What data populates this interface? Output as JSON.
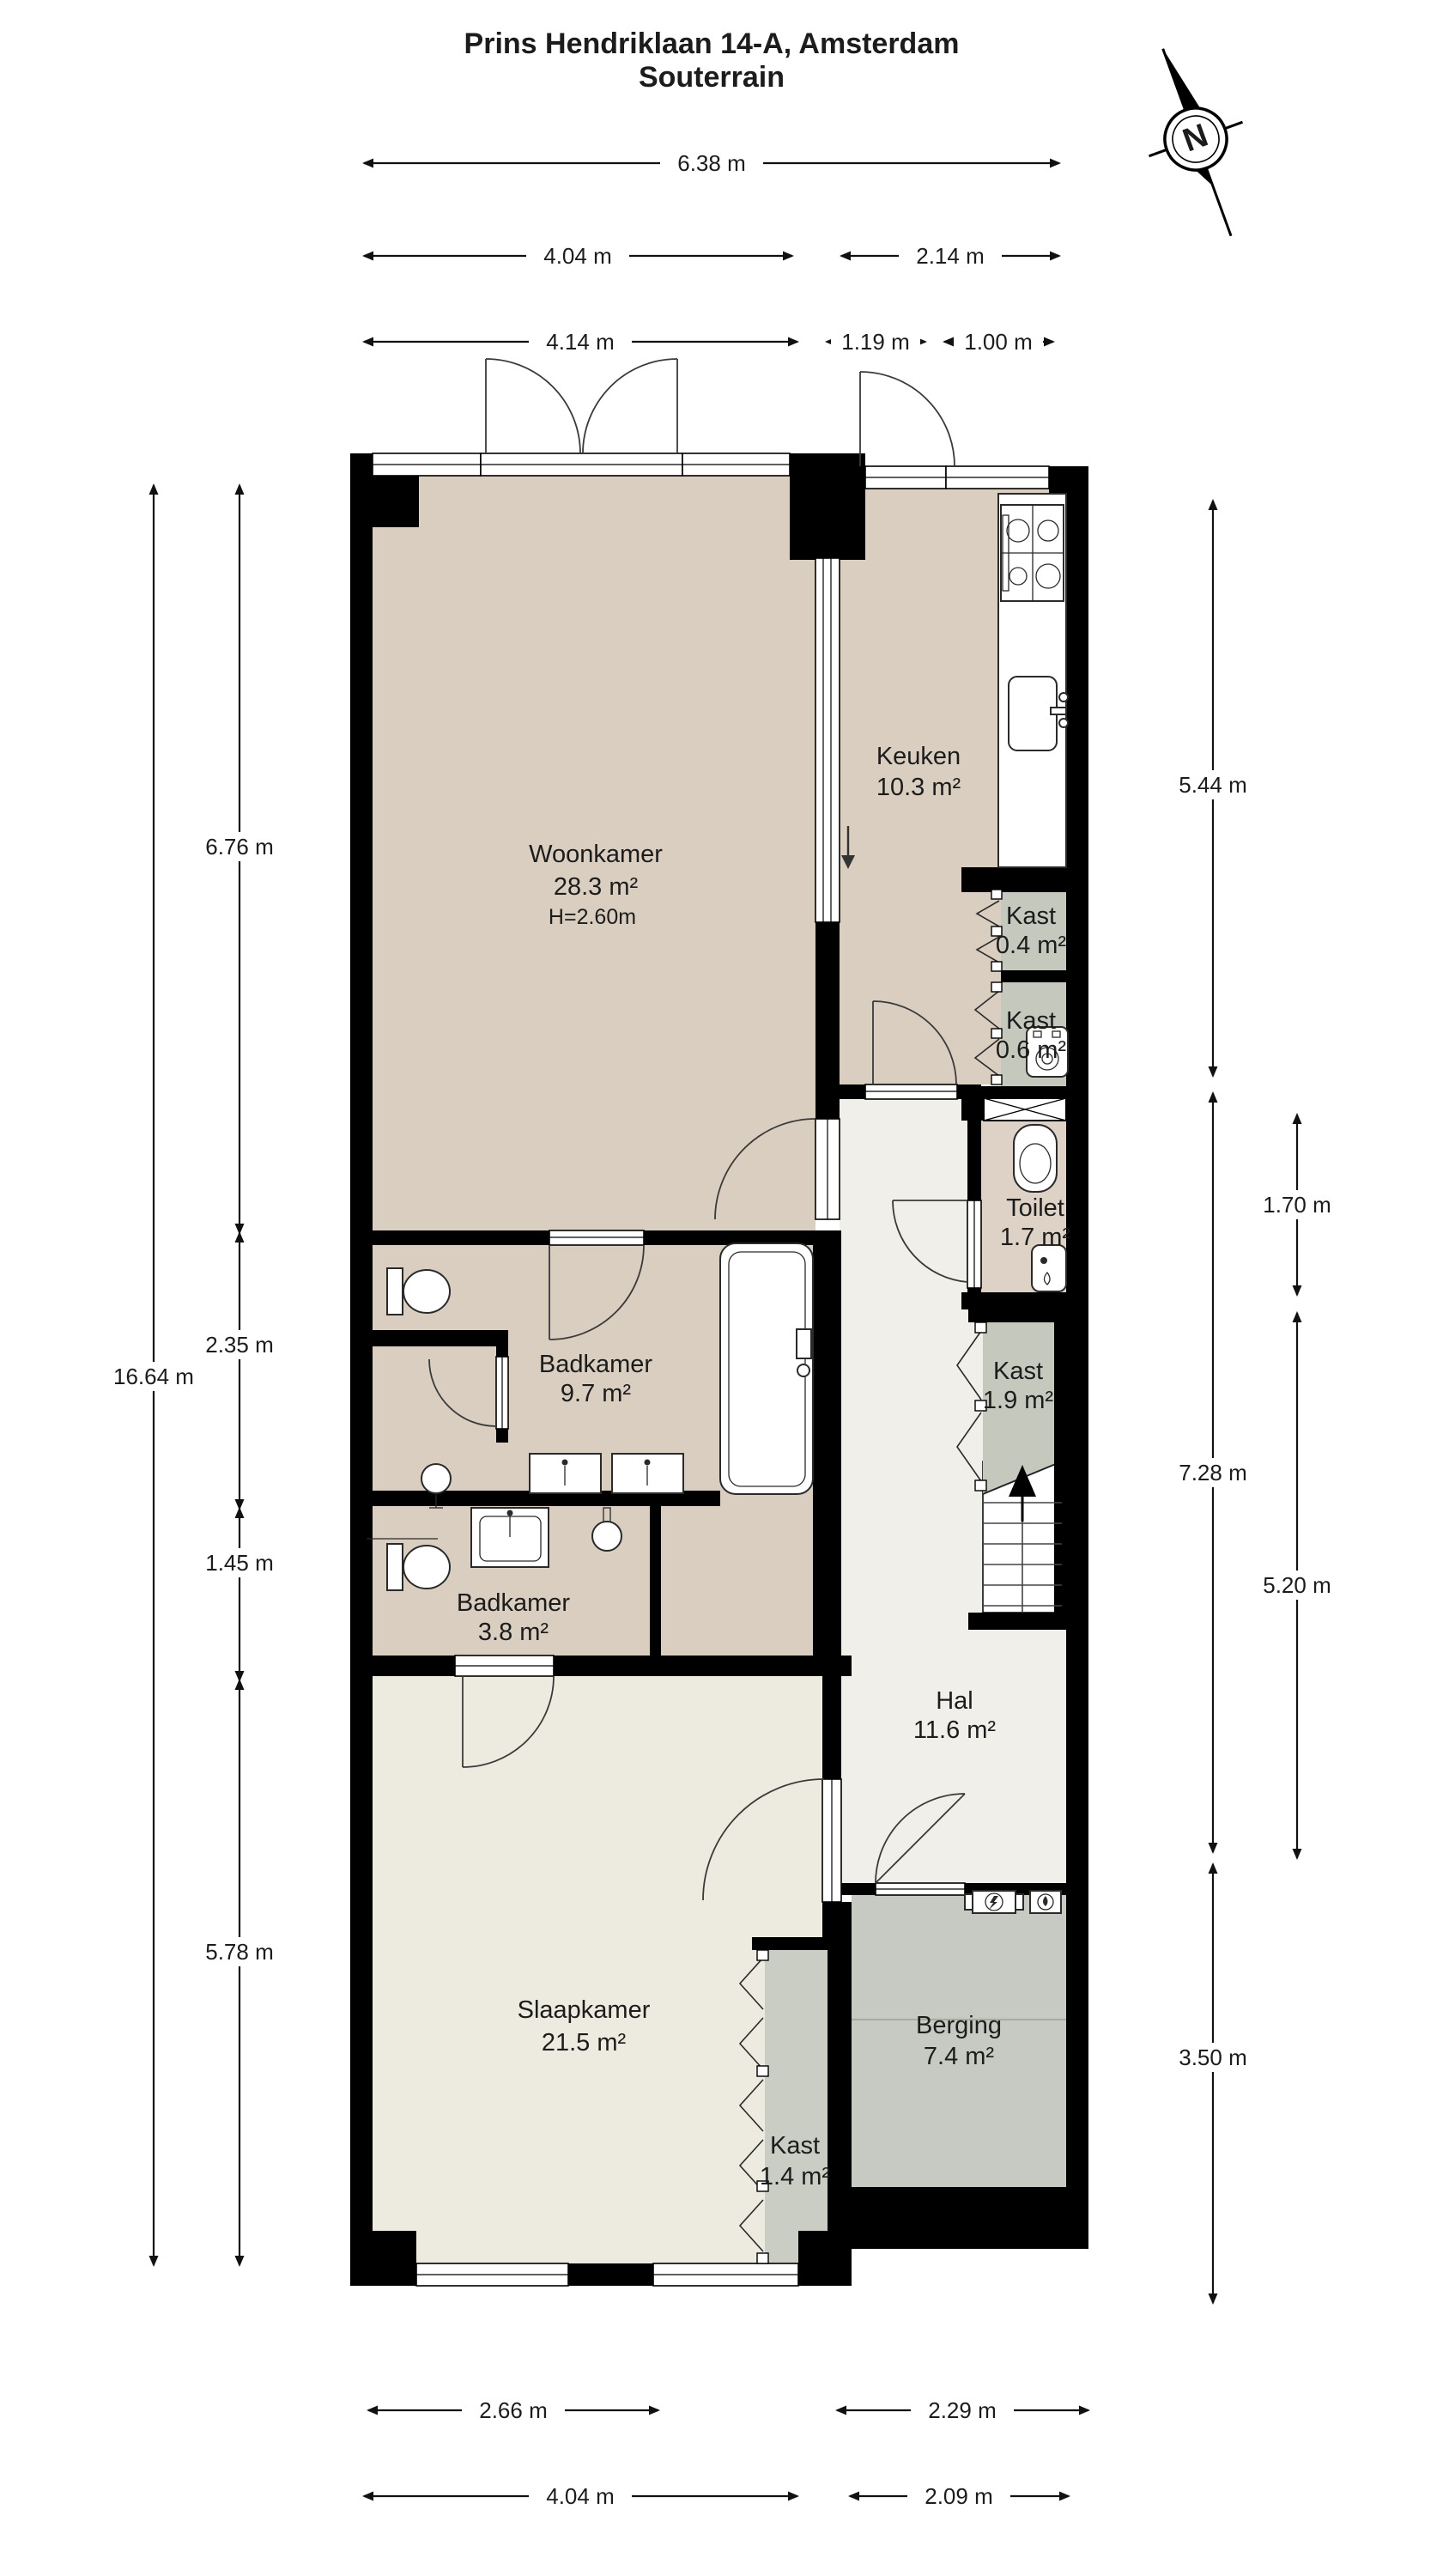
{
  "title": {
    "line1": "Prins Hendriklaan 14-A, Amsterdam",
    "line2": "Souterrain"
  },
  "compass": {
    "letter": "N"
  },
  "rooms": {
    "woonkamer": {
      "name": "Woonkamer",
      "area": "28.3 m²",
      "height": "H=2.60m"
    },
    "keuken": {
      "name": "Keuken",
      "area": "10.3 m²"
    },
    "kast04": {
      "name": "Kast",
      "area": "0.4 m²"
    },
    "kast06": {
      "name": "Kast",
      "area": "0.6 m²"
    },
    "toilet": {
      "name": "Toilet",
      "area": "1.7 m²"
    },
    "kast19": {
      "name": "Kast",
      "area": "1.9 m²"
    },
    "hal": {
      "name": "Hal",
      "area": "11.6 m²"
    },
    "badkamer97": {
      "name": "Badkamer",
      "area": "9.7 m²"
    },
    "badkamer38": {
      "name": "Badkamer",
      "area": "3.8 m²"
    },
    "slaapkamer": {
      "name": "Slaapkamer",
      "area": "21.5 m²"
    },
    "kast14": {
      "name": "Kast",
      "area": "1.4 m²"
    },
    "berging": {
      "name": "Berging",
      "area": "7.4 m²"
    }
  },
  "dims": {
    "top_total": "6.38 m",
    "top_left_a": "4.04 m",
    "top_right_a": "2.14 m",
    "top_left_b": "4.14 m",
    "top_mid_b": "1.19 m",
    "top_right_b": "1.00 m",
    "left_total": "16.64 m",
    "left_1": "6.76 m",
    "left_2": "2.35 m",
    "left_3": "1.45 m",
    "left_4": "5.78 m",
    "right_1": "5.44 m",
    "right_2": "7.28 m",
    "right_3": "3.50 m",
    "right_inner_1": "1.70 m",
    "right_inner_2": "5.20 m",
    "bottom_left_a": "2.66 m",
    "bottom_right_a": "2.29 m",
    "bottom_left_b": "4.04 m",
    "bottom_right_b": "2.09 m"
  }
}
